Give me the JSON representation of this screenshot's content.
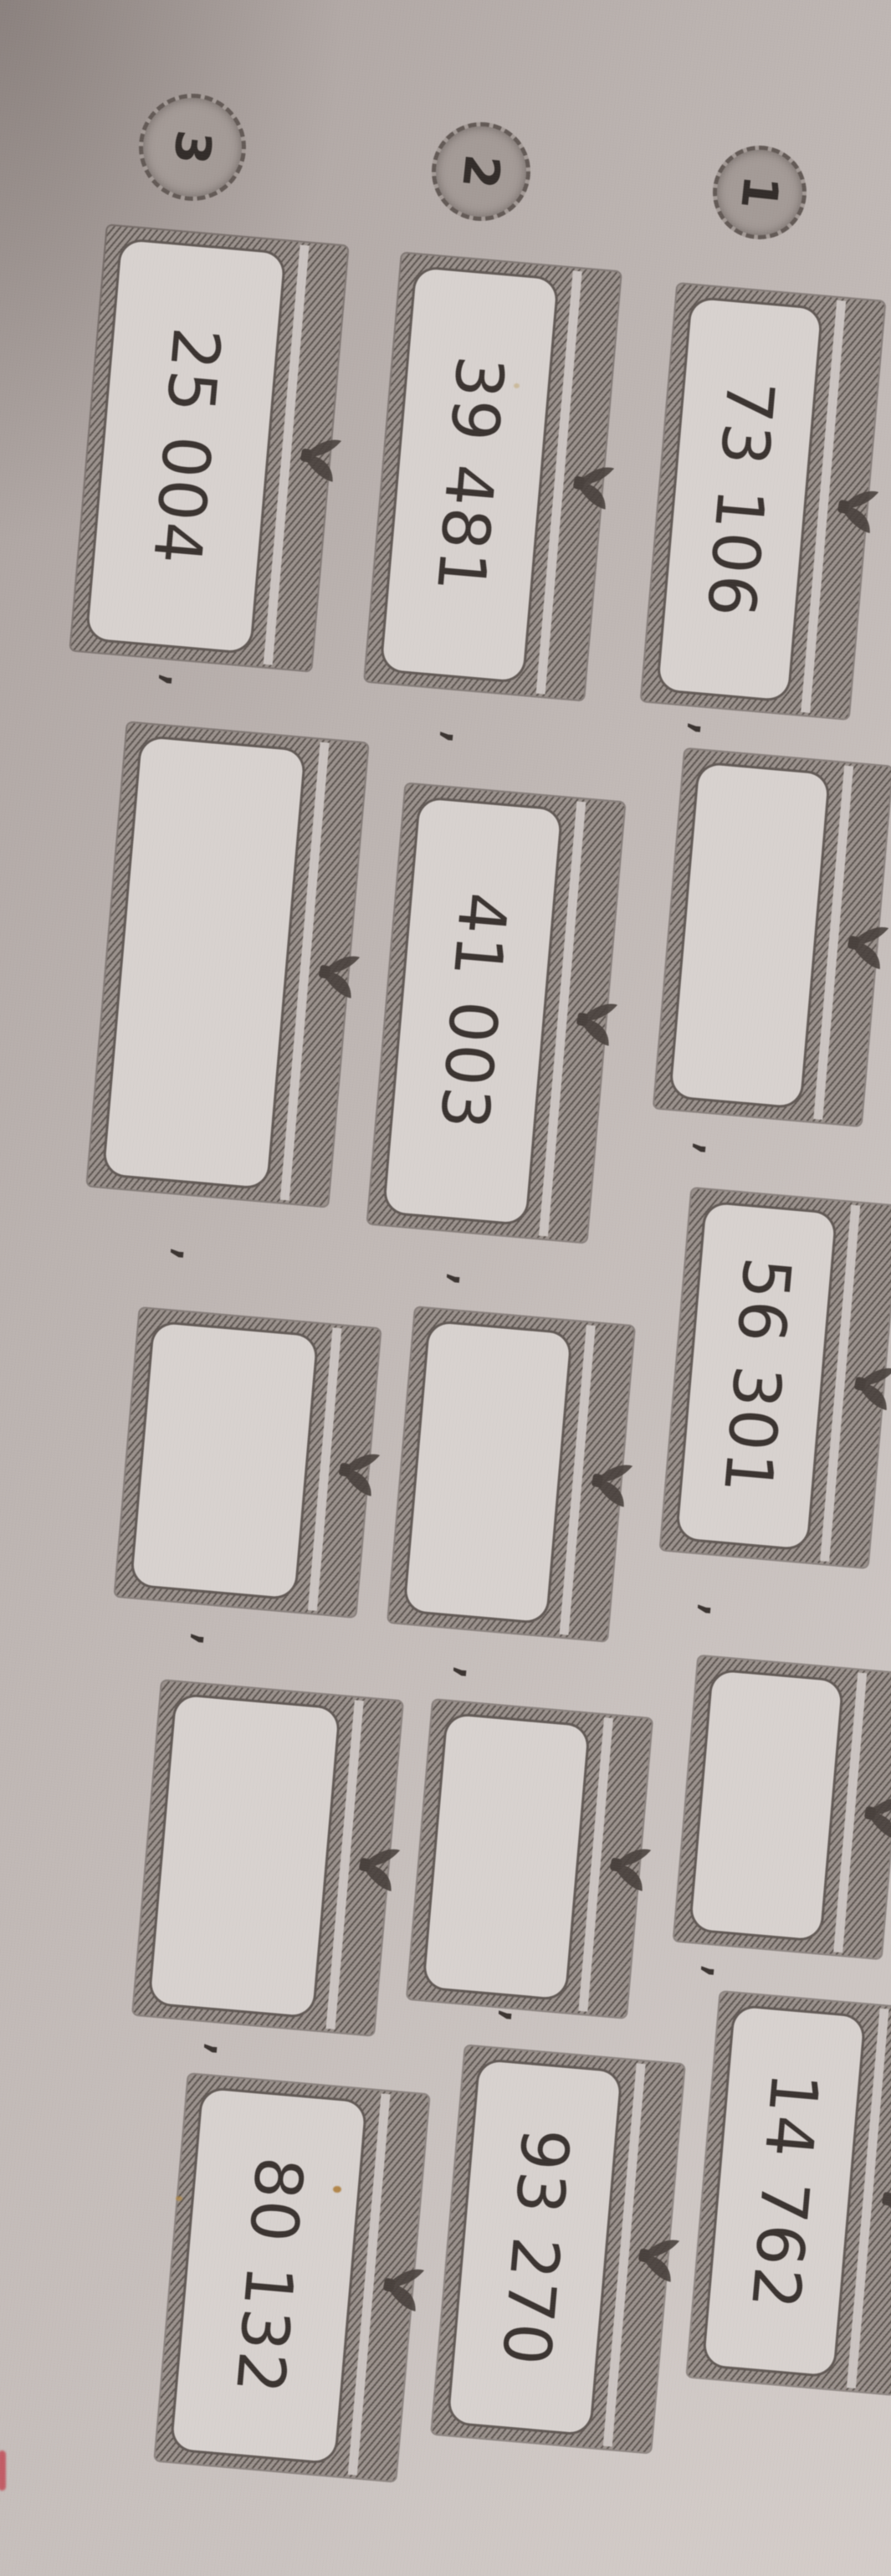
{
  "worksheet": {
    "problems": [
      {
        "label": "1",
        "items": [
          "73 106",
          "",
          "56 301",
          "",
          "14 762"
        ]
      },
      {
        "label": "2",
        "items": [
          "39 481",
          "41 003",
          "",
          "",
          "93 270"
        ]
      },
      {
        "label": "3",
        "items": [
          "25 004",
          "",
          "",
          "",
          "80 132"
        ]
      }
    ],
    "separator": ","
  },
  "colors": {
    "paper": "#c5bdba",
    "ink": "#3b3431",
    "frame_hatch": "#968d88",
    "box_fill": "#d8d2cf",
    "badge_fill": "#a49b97",
    "red_mark": "#c25d66",
    "orange_speck": "#a9752c"
  }
}
